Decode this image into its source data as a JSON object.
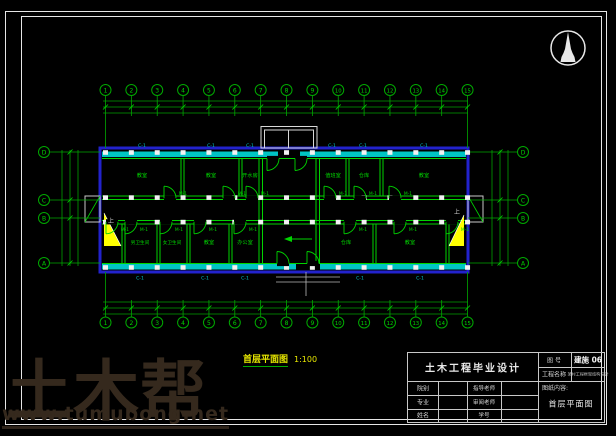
{
  "colors": {
    "wall": "#00d400",
    "axis": "#00a800",
    "window": "#00c8c8",
    "outline": "#2222cc",
    "highlight": "#ffff00",
    "frame": "#e6e6e6",
    "caption": "#e8e800",
    "watermark": "#35291d"
  },
  "plan": {
    "caption": {
      "title": "首层平面图",
      "scale": "1:100"
    },
    "axes": {
      "top": [
        "1",
        "2",
        "3",
        "4",
        "5",
        "6",
        "7",
        "8",
        "9",
        "10",
        "11",
        "12",
        "13",
        "14",
        "15"
      ],
      "bottom": [
        "1",
        "2",
        "3",
        "4",
        "5",
        "6",
        "7",
        "8",
        "9",
        "10",
        "11",
        "12",
        "13",
        "14",
        "15"
      ],
      "left": [
        "D",
        "C",
        "B",
        "A"
      ],
      "right": [
        "D",
        "C",
        "B",
        "A"
      ]
    },
    "rooms": {
      "top": [
        "教室",
        "教室",
        "开水房",
        "值班室",
        "仓库",
        "教室"
      ],
      "bottom": [
        "男卫生间",
        "女卫生间",
        "教室",
        "办公室",
        "仓库",
        "教室"
      ]
    },
    "tags": {
      "window": "C-1",
      "door": "M-1",
      "up": "上"
    }
  },
  "title_block": {
    "project_title": "土木工程毕业设计",
    "drawing_no_label": "图 号",
    "drawing_no": "建施 06",
    "project_name_label": "工程名称",
    "project_name": "某村工程框架结构设计",
    "content_label": "图纸内容:",
    "content": "首层平面图",
    "rows": [
      {
        "c1": "院别",
        "c3": "指导老师"
      },
      {
        "c1": "专业",
        "c3": "审阅老师"
      },
      {
        "c1": "姓名",
        "c3": "学号"
      }
    ]
  },
  "watermark": {
    "brand": "土木帮",
    "url": "www.tumubong.net"
  }
}
